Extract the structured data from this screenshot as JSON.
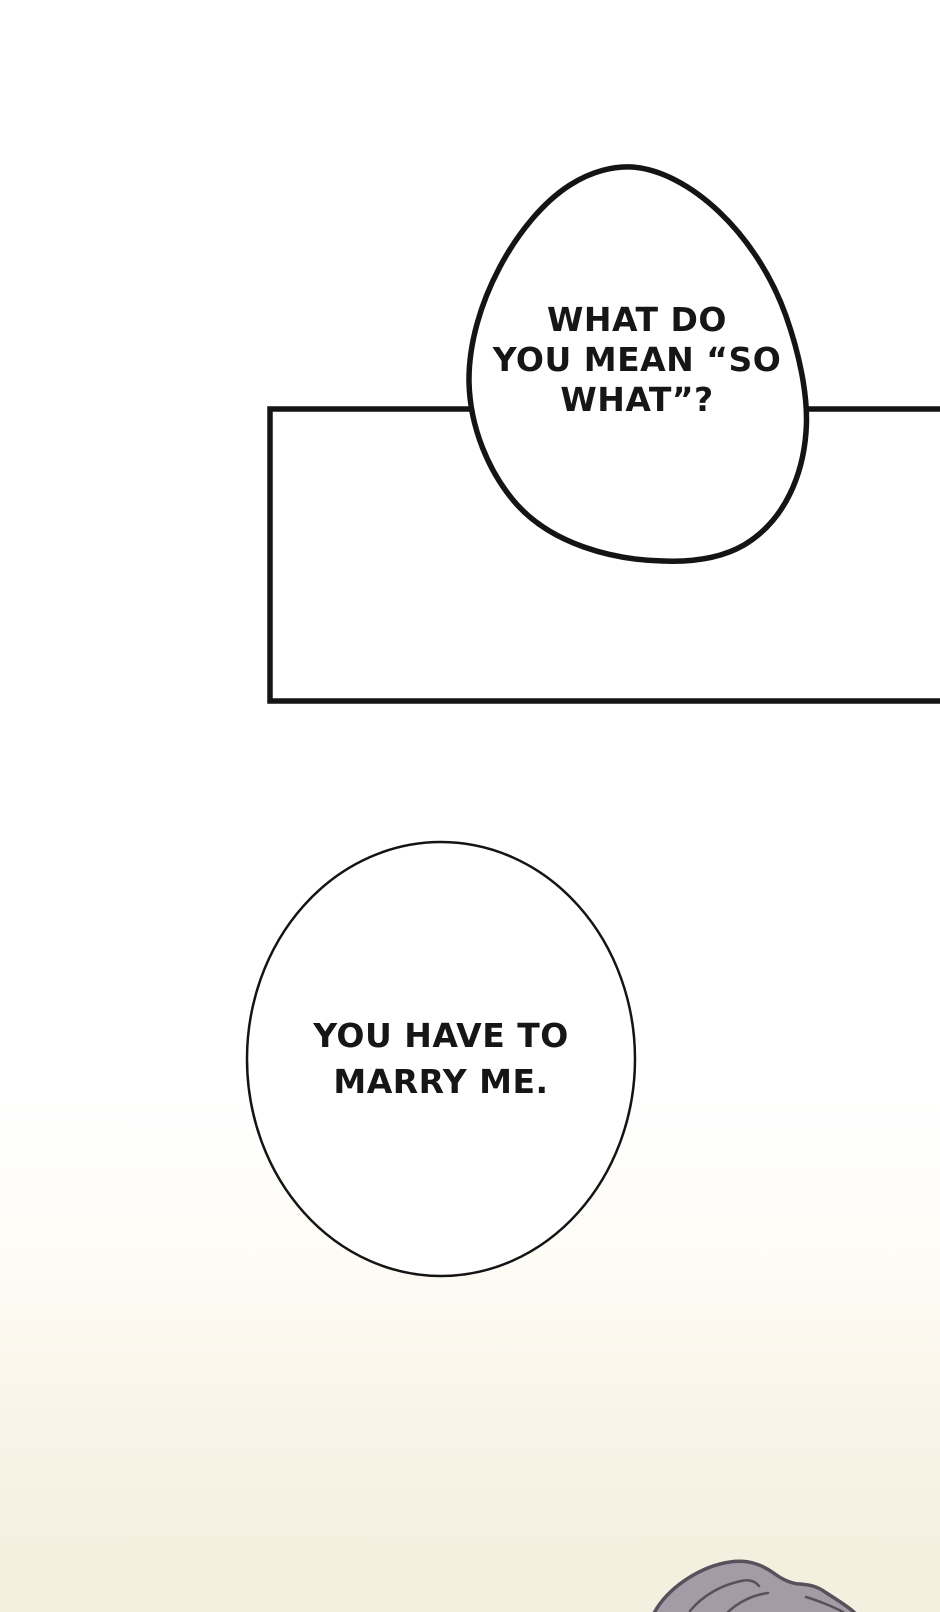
{
  "colors": {
    "white": "#ffffff",
    "ink": "#141414",
    "cream_light": "#fdfbf4",
    "cream_mid": "#f9f4e8",
    "paper_cream": "#f5efe0",
    "hair_fill": "#a59ba6",
    "hair_shade": "#9b919e",
    "hair_outline": "#5a505c"
  },
  "speech": {
    "bubble1": {
      "text": "WHAT DO\nYOU MEAN “SO\nWHAT”?"
    },
    "bubble2": {
      "text": "YOU HAVE TO\nMARRY ME."
    }
  }
}
